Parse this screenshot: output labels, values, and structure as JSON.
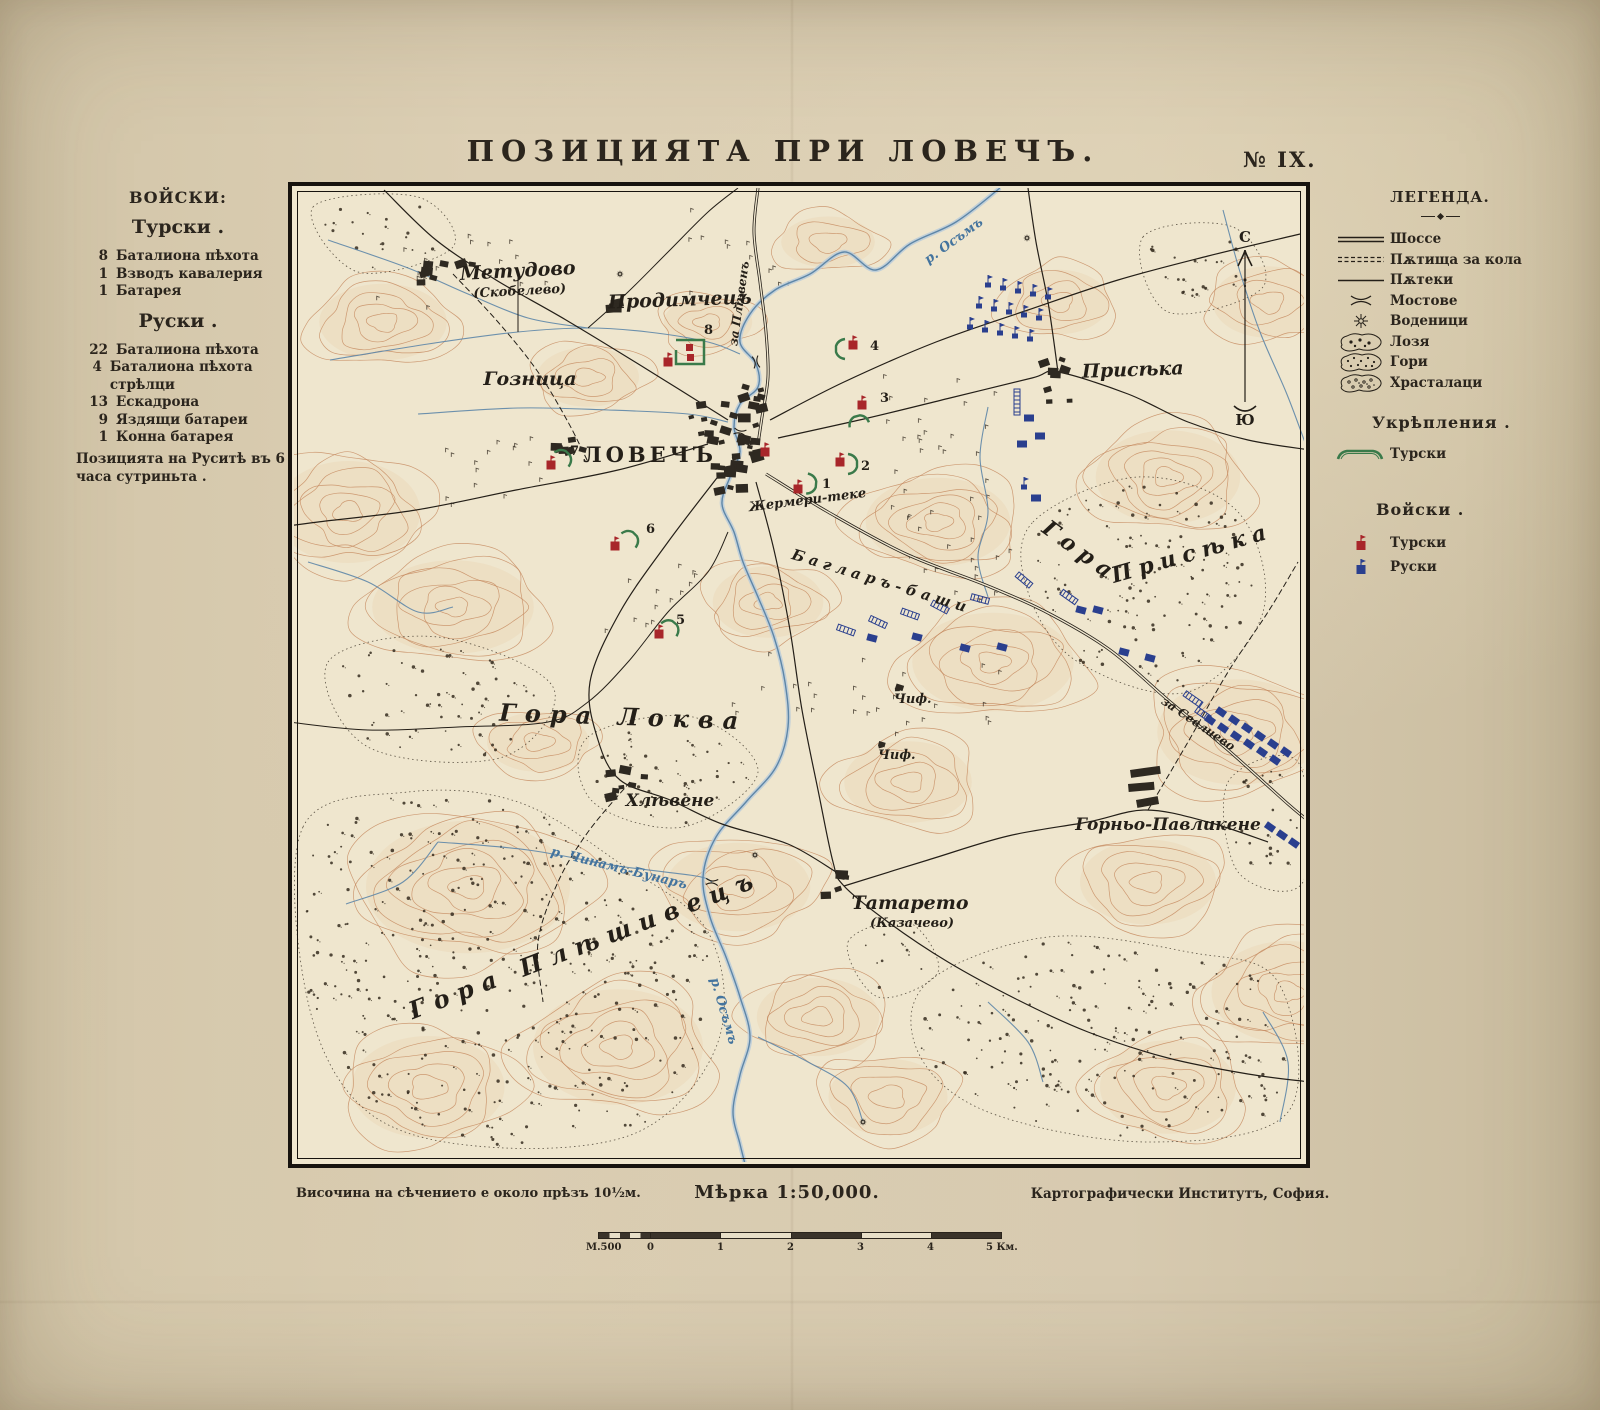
{
  "title": "ПОЗИЦИЯТА ПРИ ЛОВЕЧЪ.",
  "sheet_number": "№ IX.",
  "left_panel": {
    "heading": "ВОЙСКИ:",
    "turkish_heading": "Турски .",
    "turkish_items": [
      {
        "num": "8",
        "label": "Баталиона пѣхота"
      },
      {
        "num": "1",
        "label": "Взводъ кавалерия"
      },
      {
        "num": "1",
        "label": "Батарея"
      }
    ],
    "russian_heading": "Руски .",
    "russian_items": [
      {
        "num": "22",
        "label": "Баталиона пѣхота"
      },
      {
        "num": "4",
        "label": "Баталиона пѣхота стрѣлци"
      },
      {
        "num": "13",
        "label": "Ескадрона"
      },
      {
        "num": "9",
        "label": "Яздящи батареи"
      },
      {
        "num": "1",
        "label": "Конна батарея"
      }
    ],
    "note": "Позицията на Руситѣ въ 6 часа сутриньта ."
  },
  "legend": {
    "heading": "ЛЕГЕНДА.",
    "items": [
      {
        "symbol": "chaussee",
        "label": "Шоссе"
      },
      {
        "symbol": "cart-roads",
        "label": "Пѫтища за кола"
      },
      {
        "symbol": "footpaths",
        "label": "Пѫтеки"
      },
      {
        "symbol": "bridges",
        "label": "Мостове"
      },
      {
        "symbol": "watermills",
        "label": "Воденици"
      },
      {
        "symbol": "vineyards",
        "label": "Лозя"
      },
      {
        "symbol": "forests",
        "label": "Гори"
      },
      {
        "symbol": "shrubs",
        "label": "Храсталаци"
      }
    ],
    "fortifications_heading": "Укрѣпления .",
    "fortifications_turkish": "Турски",
    "troops_heading": "Войски .",
    "troops_turkish": "Турски",
    "troops_russian": "Руски"
  },
  "footer": {
    "contour_note": "Височина на сѣчението е около прѣзъ 10½м.",
    "scale_label": "Мѣрка 1:50,000.",
    "publisher": "Картографически Институтъ, София.",
    "scalebar_labels": [
      "М.500",
      "0",
      "1",
      "2",
      "3",
      "4",
      "5 Км."
    ]
  },
  "map": {
    "labels": {
      "metudovo": "Метудово",
      "metudovo_alt": "(Скобелево)",
      "prodimchets": "Продимчецъ",
      "goznitsa": "Гозница",
      "lovech": "ЛОВЕЧЪ",
      "priseka": "Присѣка",
      "gora_priseka_1": "Гора",
      "gora_priseka_2": "Присѣка",
      "baglar_bashi": "Багларъ-баши",
      "gora_lokva": "Гора Локва",
      "hlevene": "Хлѣвене",
      "gora_pleshivets": "Гора Плѣшивецъ",
      "tatareto": "Татарето",
      "tatareto_alt": "(Казачево)",
      "gornyo_pavlikene": "Горньо-Павликене",
      "zhermeri": "Жермери-теке",
      "chif1": "Чиф.",
      "chif2": "Чиф.",
      "river_osam_north": "р. Осъмъ",
      "river_osam_south": "р. Осъмъ",
      "river_chinam": "р. Чинамъ-Бунаръ",
      "road_pleven": "за Плѣвенъ",
      "road_sevlievo": "за Севлиево",
      "compass_north": "С",
      "compass_south": "Ю",
      "redoubt_numbers": [
        "1",
        "2",
        "3",
        "4",
        "5",
        "6",
        "7",
        "8"
      ]
    }
  },
  "colors": {
    "paper": "#d7cab0",
    "map_bg": "#efe6ce",
    "ink": "#241f18",
    "contour": "#c4875c",
    "water": "#5d86a8",
    "turkish_red": "#a8262a",
    "russian_blue": "#2a3f8e",
    "fortification_green": "#3a7a4a"
  }
}
